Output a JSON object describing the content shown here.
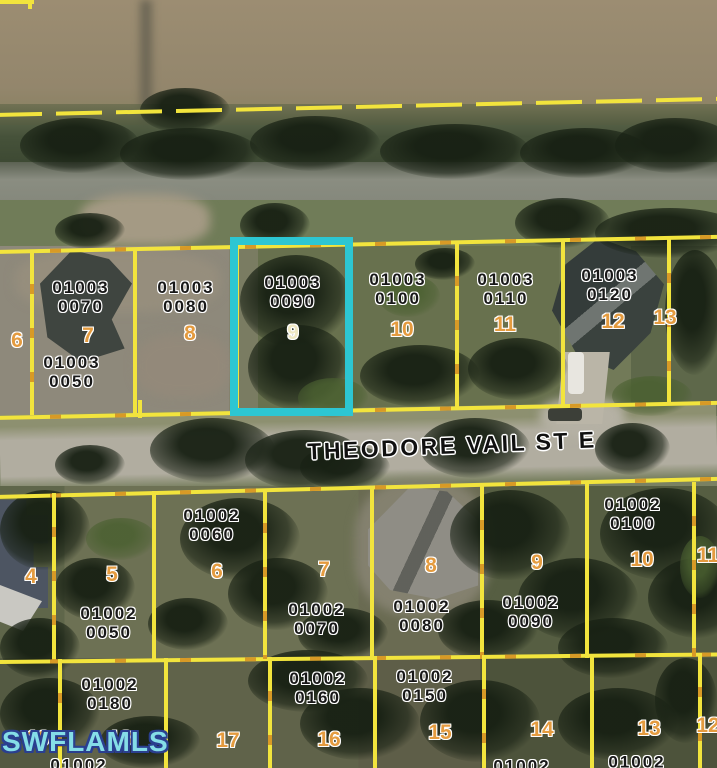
{
  "watermark": {
    "text": "SWFLAMLS"
  },
  "street": {
    "label": "THEODORE VAIL ST E"
  },
  "highlight": {
    "apn": "01003 0090",
    "lot": "9",
    "border_color": "#2dc6d2"
  },
  "colors": {
    "boundary_yellow": "#f2e43d",
    "boundary_orange_dash": "#d89a26",
    "lot_number_orange": "#e49b3f",
    "highlighted_lot_number": "#efe8c2",
    "watermark_fill": "#85dde7",
    "watermark_outline": "#2a3f8f"
  },
  "north_block": {
    "parcels": [
      {
        "apn1": "01003",
        "apn2": "0050",
        "lot": "6"
      },
      {
        "apn1": "01003",
        "apn2": "0070",
        "lot": "7"
      },
      {
        "apn1": "01003",
        "apn2": "0080",
        "lot": "8"
      },
      {
        "apn1": "01003",
        "apn2": "0090",
        "lot": "9",
        "highlighted": true
      },
      {
        "apn1": "01003",
        "apn2": "0100",
        "lot": "10"
      },
      {
        "apn1": "01003",
        "apn2": "0110",
        "lot": "11"
      },
      {
        "apn1": "01003",
        "apn2": "0120",
        "lot": "12"
      },
      {
        "lot": "13"
      }
    ]
  },
  "south_block_front": {
    "parcels": [
      {
        "lot": "4"
      },
      {
        "apn1": "01002",
        "apn2": "0050",
        "lot": "5"
      },
      {
        "apn1": "01002",
        "apn2": "0060",
        "lot": "6"
      },
      {
        "apn1": "01002",
        "apn2": "0070",
        "lot": "7"
      },
      {
        "apn1": "01002",
        "apn2": "0080",
        "lot": "8"
      },
      {
        "apn1": "01002",
        "apn2": "0090",
        "lot": "9"
      },
      {
        "apn1": "01002",
        "apn2": "0100",
        "lot": "10"
      },
      {
        "lot": "11"
      }
    ]
  },
  "south_block_rear": {
    "parcels": [
      {
        "lot": "19",
        "apn1": "01002"
      },
      {
        "apn1": "01002",
        "apn2": "0180",
        "lot": "18"
      },
      {
        "lot": "17"
      },
      {
        "apn1": "01002",
        "apn2": "0160",
        "lot": "16"
      },
      {
        "apn1": "01002",
        "apn2": "0150",
        "lot": "15"
      },
      {
        "lot": "14",
        "apn1": "01002"
      },
      {
        "lot": "13",
        "apn1": "01002"
      },
      {
        "lot": "12"
      }
    ]
  }
}
